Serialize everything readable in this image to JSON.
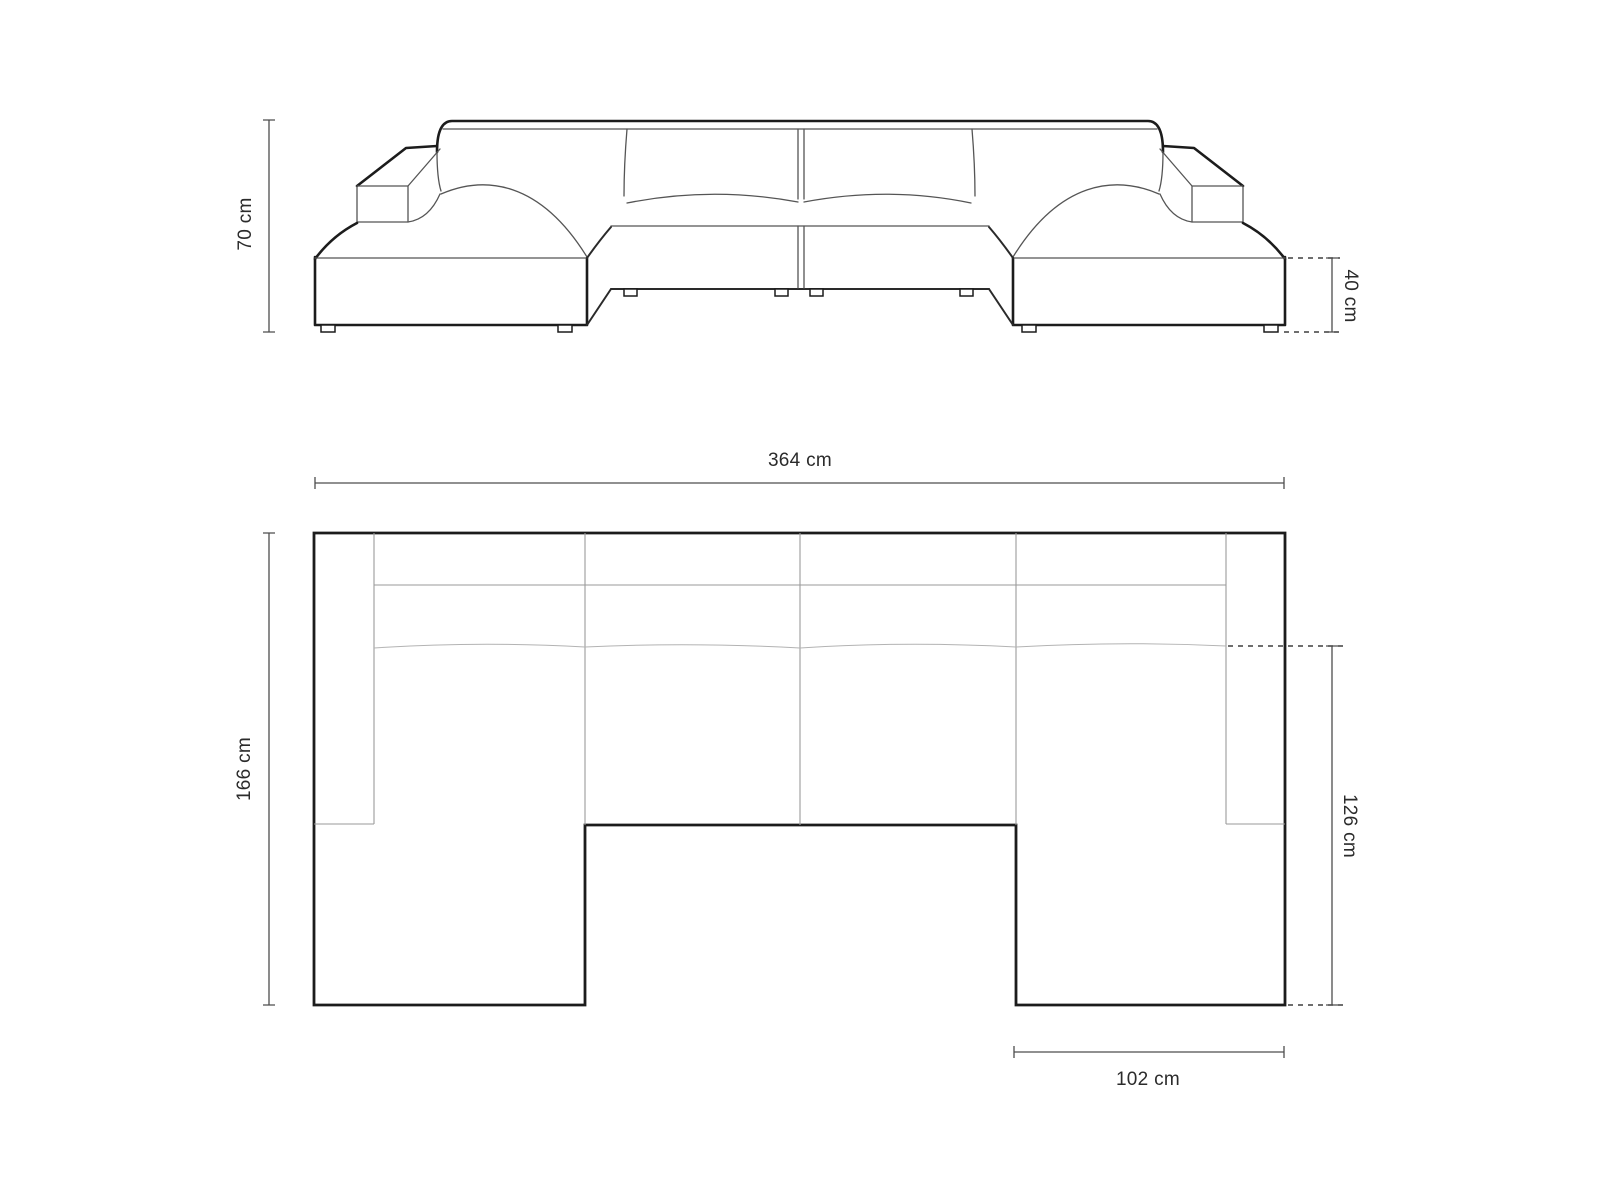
{
  "canvas": {
    "width_px": 1600,
    "height_px": 1200,
    "background": "#ffffff"
  },
  "front_elevation_view": {
    "dimension_labels": {
      "overall_height": "70 cm",
      "seat_height": "40 cm"
    }
  },
  "top_plan_view": {
    "dimension_labels": {
      "overall_width": "364 cm",
      "overall_depth": "166 cm",
      "chaise_depth": "126 cm",
      "chaise_width": "102 cm"
    }
  },
  "style_colors": {
    "outline": "#1c1c1c",
    "interior_lines": "#9a9a9a",
    "dimension_lines": "#4d4d4d",
    "dotted_extension_lines": "#3f3f3f",
    "label_text": "#2b2b2b"
  }
}
